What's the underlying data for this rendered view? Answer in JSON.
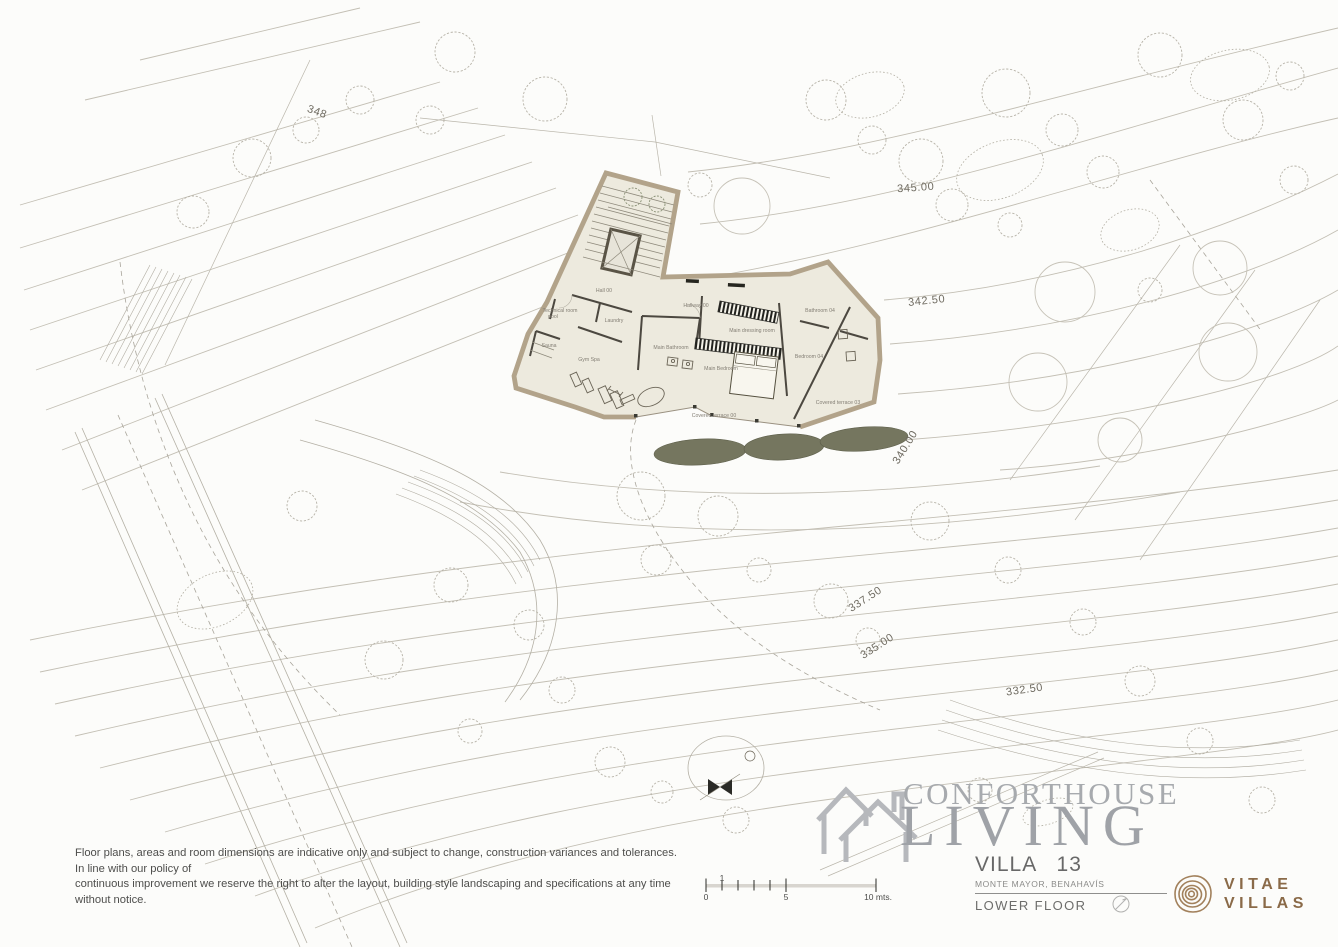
{
  "title_block": {
    "title": "VILLA   13",
    "subtitle": "MONTE MAYOR, BENAHAVÍS",
    "floor_label": "LOWER FLOOR"
  },
  "logo": {
    "name_top": "VITAE",
    "name_bottom": "VILLAS",
    "brand_color": "#8a6a48"
  },
  "watermark": {
    "brand": "CONFORTHOUSE",
    "word": "LIVING"
  },
  "disclaimer": {
    "line1": "Floor plans, areas and room dimensions are indicative only and subject to change, construction variances and tolerances. In line with our policy of",
    "line2": "continuous improvement we reserve the right to alter the layout, building style landscaping and specifications at any time without notice."
  },
  "scale_bar": {
    "labels": [
      {
        "t": "0",
        "x": 706,
        "y": 900
      },
      {
        "t": "1",
        "x": 722,
        "y": 881
      },
      {
        "t": "5",
        "x": 786,
        "y": 900
      },
      {
        "t": "10 mts.",
        "x": 878,
        "y": 900
      }
    ]
  },
  "site": {
    "elevation_labels": [
      {
        "t": "345.00",
        "x": 916,
        "y": 191,
        "r": -4
      },
      {
        "t": "342.50",
        "x": 927,
        "y": 304,
        "r": -6
      },
      {
        "t": "340.00",
        "x": 908,
        "y": 449,
        "r": -58
      },
      {
        "t": "337.50",
        "x": 867,
        "y": 602,
        "r": -33
      },
      {
        "t": "335.00",
        "x": 879,
        "y": 649,
        "r": -33
      },
      {
        "t": "332.50",
        "x": 1025,
        "y": 693,
        "r": -8
      },
      {
        "t": "348",
        "x": 316,
        "y": 115,
        "r": 20
      }
    ]
  },
  "rooms": [
    {
      "t": "Hall 00",
      "x": 604,
      "y": 292
    },
    {
      "t": "Hallway 00",
      "x": 696,
      "y": 307
    },
    {
      "t": "Technical room",
      "x": 560,
      "y": 312
    },
    {
      "t": "pool",
      "x": 553,
      "y": 318
    },
    {
      "t": "Laundry",
      "x": 614,
      "y": 322
    },
    {
      "t": "Sauna",
      "x": 549,
      "y": 347
    },
    {
      "t": "Gym Spa",
      "x": 589,
      "y": 361
    },
    {
      "t": "Main Bathroom",
      "x": 671,
      "y": 349
    },
    {
      "t": "Main dressing room",
      "x": 752,
      "y": 332
    },
    {
      "t": "Main Bedroom",
      "x": 721,
      "y": 370
    },
    {
      "t": "Bathroom 04",
      "x": 820,
      "y": 312
    },
    {
      "t": "Bedroom 04",
      "x": 809,
      "y": 358
    },
    {
      "t": "Covered terrace 00",
      "x": 714,
      "y": 417
    },
    {
      "t": "Covered terrace 03",
      "x": 838,
      "y": 404
    }
  ],
  "colors": {
    "wall_tan": "#b2a38a",
    "floor": "#edeade",
    "hedge_olive": "#75765f",
    "contour_gray": "#c3bfb4"
  }
}
